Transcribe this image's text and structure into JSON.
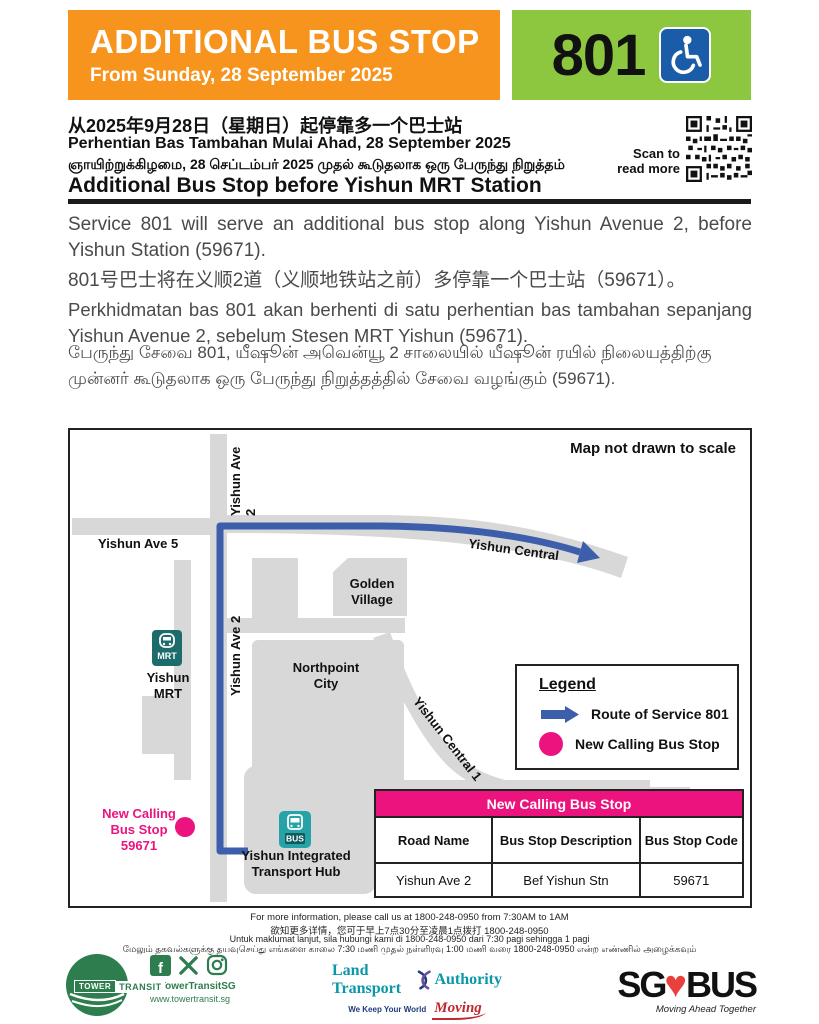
{
  "header": {
    "title": "ADDITIONAL BUS STOP",
    "subtitle": "From Sunday, 28 September 2025",
    "service_number": "801"
  },
  "intro": {
    "line_zh": "从2025年9月28日（星期日）起停靠多一个巴士站",
    "line_ms": "Perhentian Bas Tambahan Mulai Ahad, 28 September 2025",
    "line_ta": "ஞாயிற்றுக்கிழமை, 28 செப்டம்பர் 2025 முதல் கூடுதலாக ஒரு பேருந்து நிறுத்தம்",
    "heading_en": "Additional Bus Stop before Yishun MRT Station",
    "qr_caption": "Scan to\nread more"
  },
  "body": {
    "para_en": "Service 801 will serve an additional bus stop along Yishun Avenue 2, before Yishun Station (59671).",
    "para_zh": "801号巴士将在义顺2道（义顺地铁站之前）多停靠一个巴士站（59671）。",
    "para_ms": "Perkhidmatan bas 801 akan berhenti di satu perhentian bas tambahan sepanjang Yishun Avenue 2, sebelum Stesen MRT Yishun (59671).",
    "para_ta": "பேருந்து சேவை 801, யீஷூன் அவென்யூ 2 சாலையில் யீஷூன் ரயில் நிலையத்திற்கு முன்னர் கூடுதலாக ஒரு பேருந்து நிறுத்தத்தில் சேவை வழங்கும் (59671)."
  },
  "map": {
    "note": "Map not drawn to scale",
    "roads": {
      "ave2": "Yishun Ave 2",
      "ave5": "Yishun Ave 5",
      "central": "Yishun Central",
      "central1": "Yishun Central 1"
    },
    "places": {
      "golden_village": "Golden\nVillage",
      "northpoint": "Northpoint\nCity",
      "mrt_label": "Yishun\nMRT",
      "mrt_badge": "MRT",
      "hub_label": "Yishun Integrated\nTransport Hub",
      "bus_badge": "BUS",
      "new_stop_label": "New Calling\nBus Stop\n59671"
    },
    "legend": {
      "title": "Legend",
      "route_label": "Route of Service 801",
      "stop_label": "New Calling Bus Stop"
    },
    "table": {
      "title": "New Calling Bus Stop",
      "headers": [
        "Road Name",
        "Bus Stop Description",
        "Bus Stop Code"
      ],
      "rows": [
        [
          "Yishun Ave 2",
          "Bef Yishun Stn",
          "59671"
        ]
      ]
    }
  },
  "footer": {
    "info_en": "For more information, please call us at 1800-248-0950 from 7:30AM to 1AM",
    "info_zh": "欲知更多详情，您可于早上7点30分至凌晨1点拨打 1800-248-0950",
    "info_ms": "Untuk maklumat lanjut, sila hubungi kami di 1800-248-0950 dari 7:30 pagi sehingga 1 pagi",
    "info_ta": "மேலும் தகவல்களுக்கு தயவுசெய்து எங்களை காலை 7:30 மணி முதல் நள்ளிரவு 1:00 மணி வரை 1800-248-0950 என்ற எண்ணில் அழைக்கவும்",
    "tower_transit": {
      "word_tower": "TOWER",
      "word_transit": "TRANSIT",
      "handle": "@TowerTransitSG",
      "website": "www.towertransit.sg"
    },
    "lta": {
      "word_1": "Land Transport",
      "word_2": "Authority",
      "tagline_1": "We Keep Your World",
      "tagline_2": "Moving"
    },
    "sg_bus": {
      "word_sg": "SG",
      "word_bus": "BUS",
      "tagline": "Moving Ahead Together"
    }
  },
  "colors": {
    "orange": "#F7941E",
    "service_green": "#8DC63F",
    "wheelchair_blue": "#1A5CA8",
    "route_blue": "#3D5EAB",
    "stop_pink": "#EC137E",
    "road_gray": "#D8D8D8",
    "mrt_teal": "#1D6B6B",
    "bus_teal": "#25A3A6",
    "brand_green": "#2E7D4F",
    "lta_teal": "#0B97A7",
    "lta_navy": "#1F3B7B",
    "accent_red": "#C1272D"
  }
}
